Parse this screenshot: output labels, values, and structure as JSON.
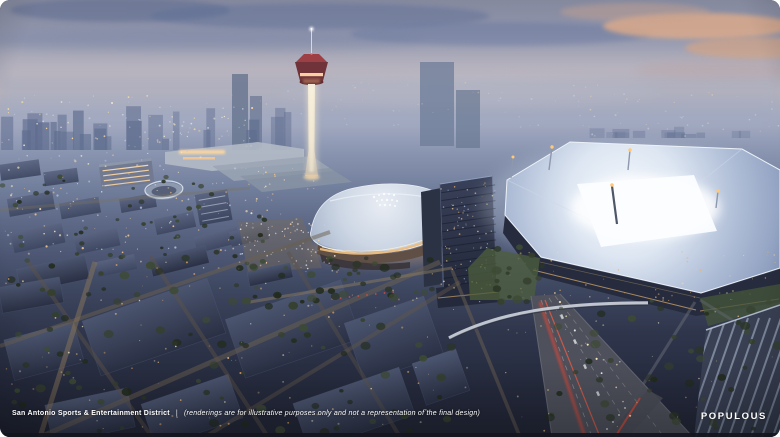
{
  "caption": {
    "title": "San Antonio Sports & Entertainment District",
    "separator": "|",
    "disclaimer": "(renderings are for illustrative purposes only and not a representation of the final design)"
  },
  "brand": {
    "name": "POPULOUS"
  },
  "scene": {
    "description": "aerial dusk rendering of a sports and entertainment district",
    "landmarks": [
      {
        "name": "tower-of-the-americas"
      },
      {
        "name": "illuminated-arena"
      },
      {
        "name": "glowing-roof-stadium"
      },
      {
        "name": "office-tower"
      },
      {
        "name": "convention-center-roofs"
      },
      {
        "name": "parking-garage"
      },
      {
        "name": "highway-with-traffic"
      },
      {
        "name": "pedestrian-bridge"
      },
      {
        "name": "distant-city-skyline"
      }
    ],
    "palette": {
      "sky_top": "#85899e",
      "sky_pink_band": "#cfc0c2",
      "sky_warm_cloud": "#dfab89",
      "haze": "#9aa4bc",
      "stadium_roof_glow": "#f6f9fd",
      "arena_roof": "#ccd6e4",
      "tower_deck_red": "#9c4046",
      "warm_lights": "#ffcf8e",
      "taillights": "#cf4a3a",
      "foreground_dark": "#262b3e",
      "text": "#ffffff"
    }
  }
}
